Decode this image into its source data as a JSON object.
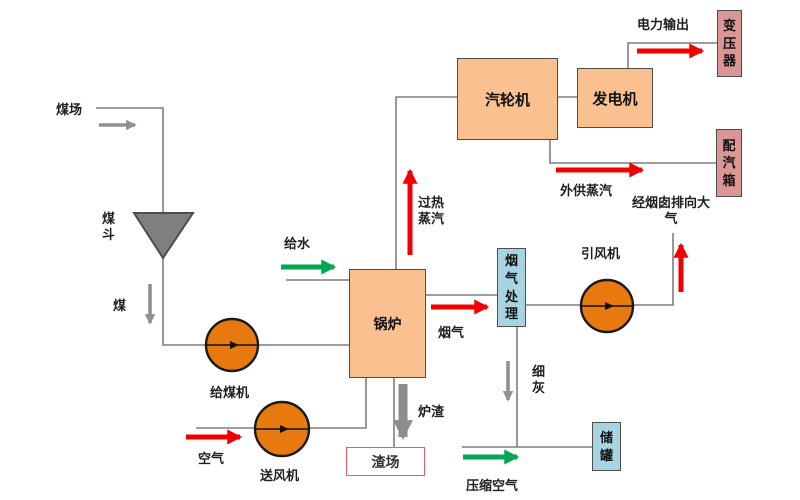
{
  "boxes": {
    "turbine": "汽轮机",
    "generator": "发电机",
    "boiler": "锅炉",
    "flue_gas_treatment": "烟气处理",
    "transformer": "变压器",
    "steam_distribution_box": "配汽箱",
    "storage_tank": "储罐",
    "slag_yard": "渣场"
  },
  "equipment": {
    "coal_hopper": "煤斗",
    "coal_feeder": "给煤机",
    "forced_draft_fan": "送风机",
    "induced_draft_fan": "引风机"
  },
  "flows": {
    "coal_yard": "煤场",
    "coal": "煤",
    "feed_water": "给水",
    "superheated_steam": "过热蒸汽",
    "air": "空气",
    "flue_gas": "烟气",
    "slag": "炉渣",
    "fine_ash": "细灰",
    "power_output": "电力输出",
    "external_steam_supply": "外供蒸汽",
    "chimney_to_atmosphere": "经烟囱排向大气",
    "compressed_air": "压缩空气"
  },
  "colors": {
    "process_box_fill": "#fac090",
    "pump_fill": "#e8790f",
    "pink_box_fill": "#d99694",
    "blue_box_fill": "#a8d3e0",
    "hopper_fill": "#7f7f7f",
    "connector_gray": "#7f7f7f",
    "red_arrow": "#f00000",
    "green_arrow": "#00a651",
    "gray_arrow": "#919191",
    "slag_yard_border": "#f25a5a"
  }
}
